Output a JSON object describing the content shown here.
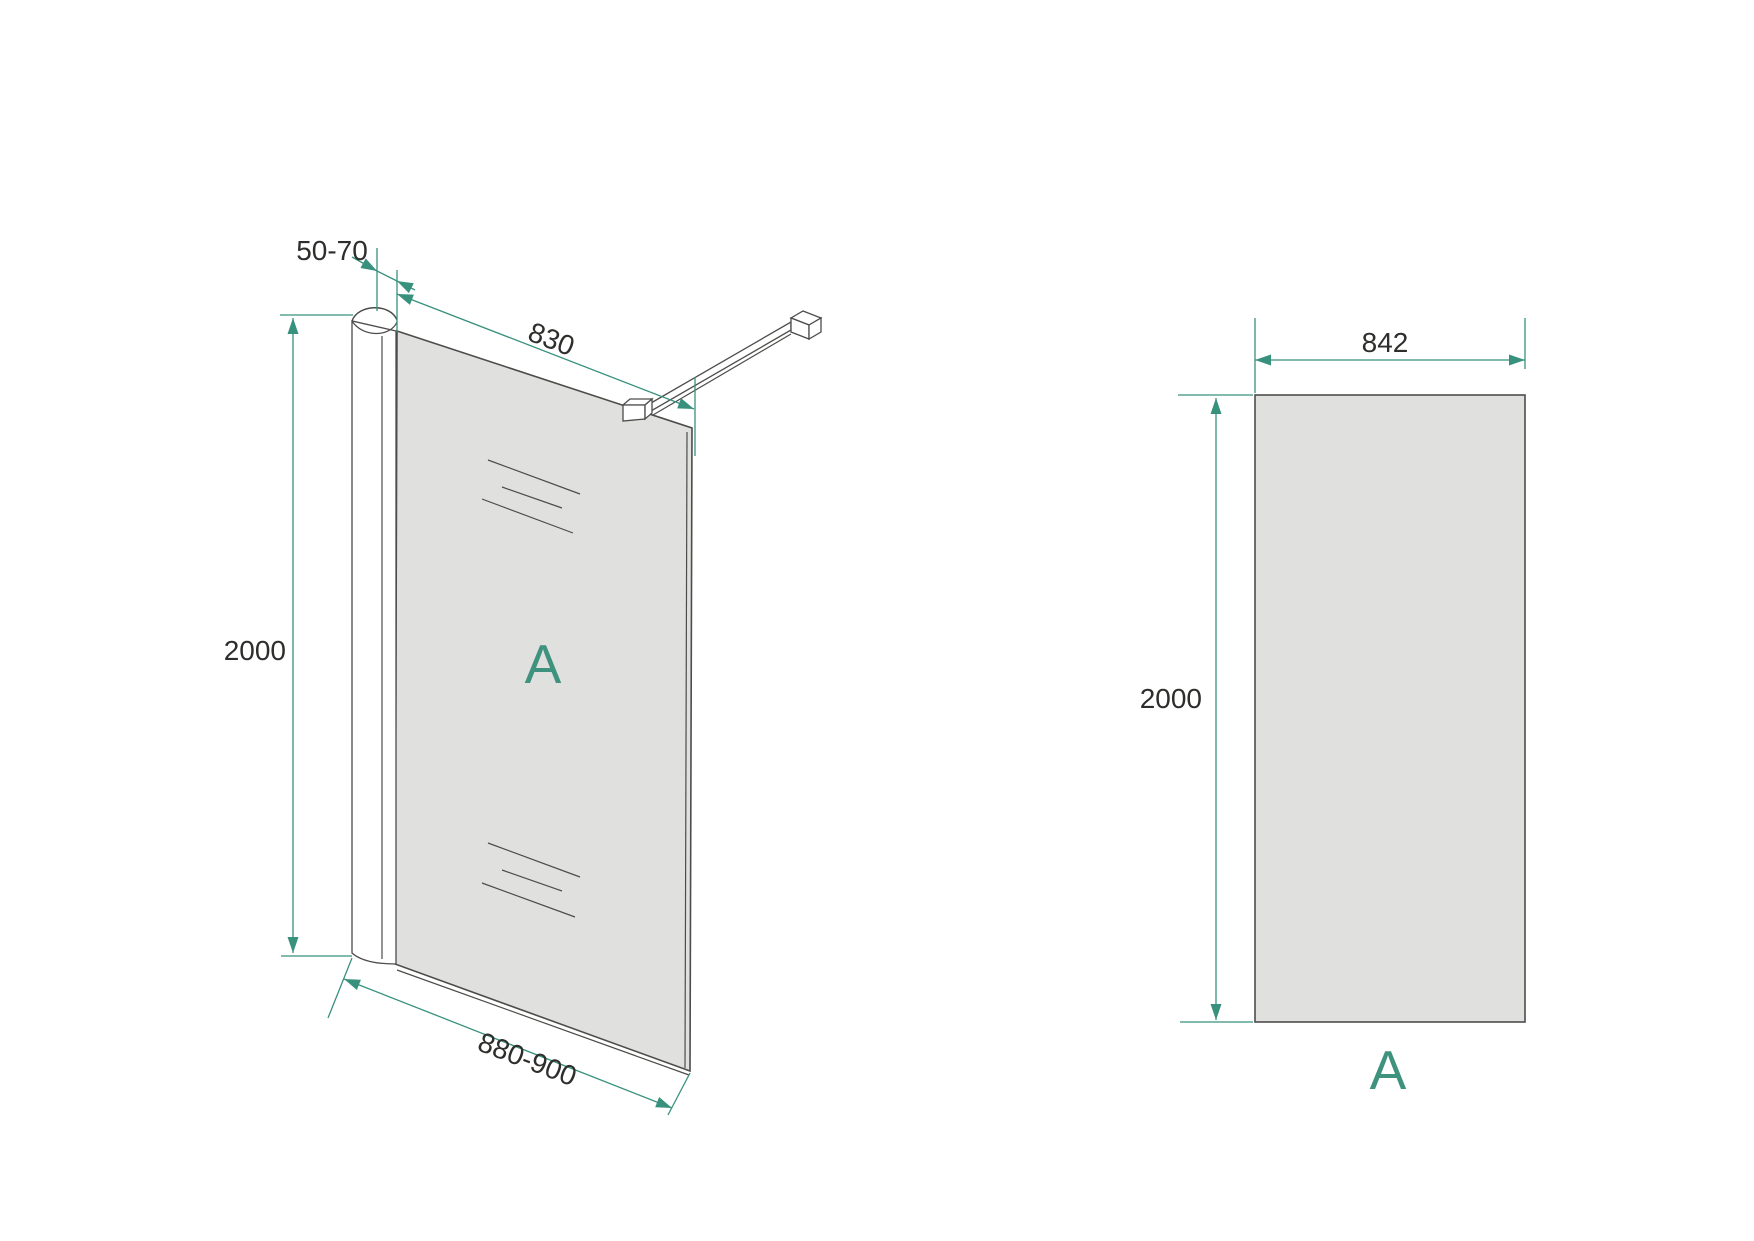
{
  "drawing": {
    "iso_view": {
      "dim_wall_gap": "50-70",
      "dim_top_width": "830",
      "dim_height": "2000",
      "dim_bottom_width": "880-900",
      "panel_label": "A"
    },
    "front_view": {
      "dim_width": "842",
      "dim_height": "2000",
      "panel_label": "A"
    }
  },
  "colors": {
    "dimension_line": "#38917D",
    "panel_label": "#3F927E",
    "dimension_text": "#2E2E2C",
    "drawing_edge": "#4C4C4A",
    "glass_fill": "#E0E0DE",
    "background": "#FFFFFF"
  }
}
